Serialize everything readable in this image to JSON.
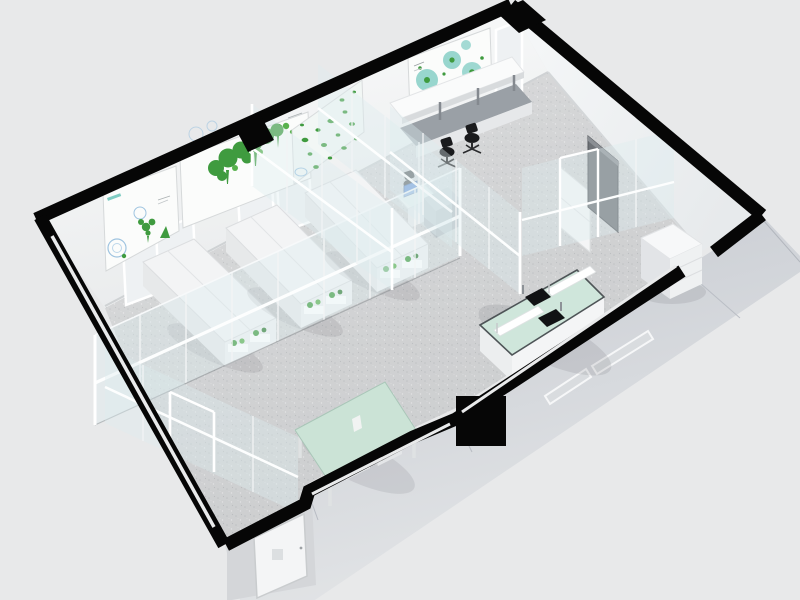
{
  "scene": {
    "description": "Isometric 3D cutaway rendering of a laboratory floor plan with black cut walls, glass partitions, plant growth racks, office desks with chairs, and mint-green lab benches",
    "counts": {
      "grow_racks": 3,
      "office_chairs": 3,
      "wall_posters": 4,
      "sinks": 2,
      "windows": 5
    },
    "colors": {
      "background": "#e8e9ea",
      "wall_cut": "#060606",
      "wall_face": "#f7f8f9",
      "wall_face_right": "#f1f3f4",
      "floor": "#d5d6d7",
      "floor_speckle": "#c3c5c7",
      "floor_speckle_light": "#ededee",
      "facade_dark": "#c6cad1",
      "facade_light": "#e2e4e6",
      "door_room": "#d4d6d9",
      "exterior_door": "#f4f5f6",
      "glass_tint": "rgba(222,236,238,0.38)",
      "glass_rail": "#fdfefe",
      "mint_table": "#cbe3d6",
      "mint_bench": "#cfe6db",
      "bench_rim": "#4e5457",
      "rack_top": "#f3f4f5",
      "rack_side": "#e7e9ea",
      "plant_green": "#3f9b3f",
      "plant_green_light": "#58b14d",
      "poster_bg": "#fbfcfb",
      "poster_teal": "#7fccc3",
      "poster_blue": "#9fc4e0",
      "desk_gray": "#9aa0a6",
      "chair_black": "#1a1b1d",
      "monitor_blue": "#4a7ed5",
      "dark_panel": "#6e7277",
      "sink_black": "#111214",
      "window_glaze": "#eef1f3"
    }
  }
}
